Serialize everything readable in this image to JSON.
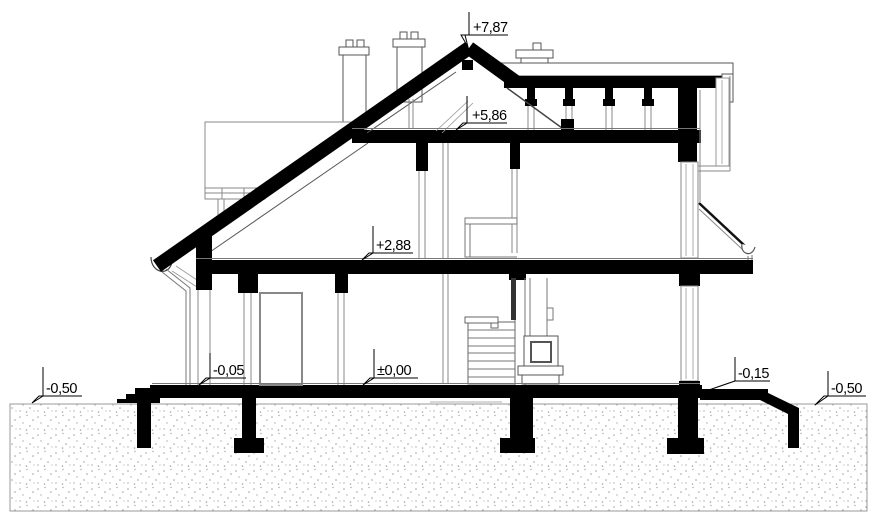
{
  "levels": [
    {
      "id": "ridge",
      "label": "+7,87"
    },
    {
      "id": "attic-floor",
      "label": "+5,86"
    },
    {
      "id": "first-floor",
      "label": "+2,88"
    },
    {
      "id": "ground-floor",
      "label": "±0,00"
    },
    {
      "id": "entry-threshold",
      "label": "-0,05"
    },
    {
      "id": "terrace",
      "label": "-0,15"
    },
    {
      "id": "grade-left",
      "label": "-0,50"
    },
    {
      "id": "grade-right",
      "label": "-0,50"
    }
  ],
  "colors": {
    "ink": "#000000",
    "background": "#ffffff",
    "outline_gray": "#777777",
    "ground_dot": "#a0a0a0"
  }
}
